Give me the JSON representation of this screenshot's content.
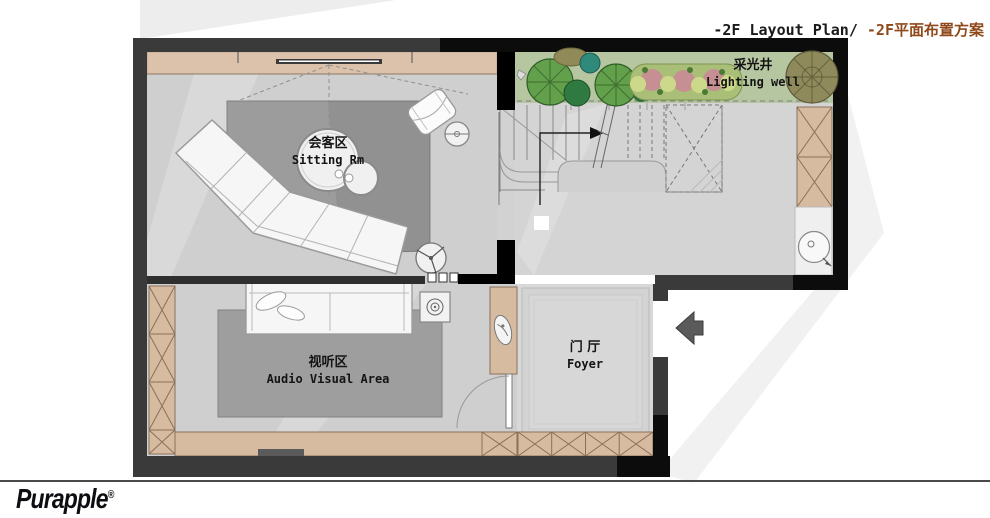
{
  "title": {
    "en": "-2F Layout Plan/ ",
    "zh": "-2F平面布置方案"
  },
  "logo": {
    "brand": "Purapple",
    "registered": "®"
  },
  "rooms": {
    "sitting": {
      "zh": "会客区",
      "en": "Sitting Rm"
    },
    "audio_visual": {
      "zh": "视听区",
      "en": "Audio Visual Area"
    },
    "foyer": {
      "zh": "门 厅",
      "en": "Foyer"
    },
    "lighting_well": {
      "zh": "采光井",
      "en": "Lighting well"
    }
  },
  "colors": {
    "accent_brown": "#8f4a1c",
    "wall_dark": "#3a3a3a",
    "wall_black": "#0c0c0c",
    "cabinet_tan": "#d8bda2",
    "floor_gray": "#cfcfcf",
    "rug_gray": "#9c9c9c",
    "garden_green": "#b5c6a0"
  },
  "icons": {
    "entry_arrow": "left-block-arrow",
    "stair_direction": "up-path-arrow",
    "plants": "tree-canopy-circles"
  }
}
